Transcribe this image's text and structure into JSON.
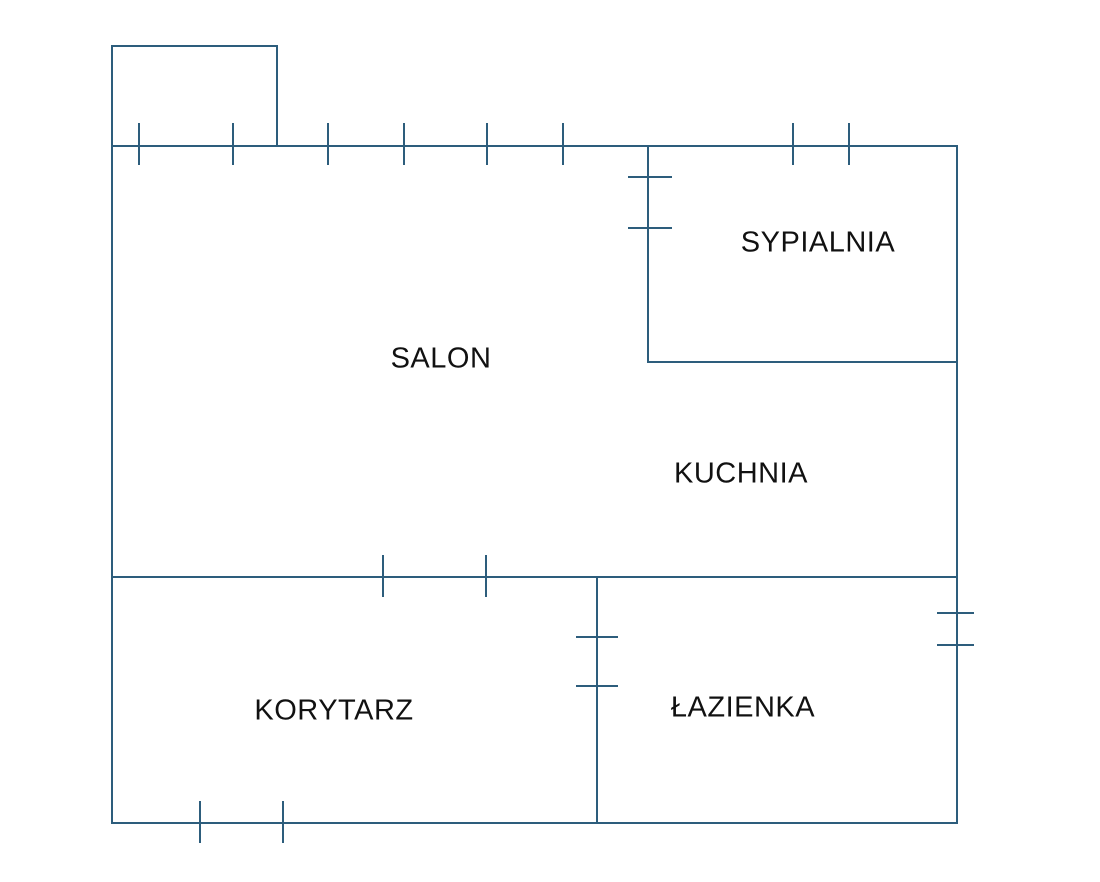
{
  "floor_plan": {
    "type": "apartment-floor-plan",
    "wall_color": "#2d5d7c",
    "label_color": "#111111",
    "rooms": [
      {
        "name": "salon",
        "label": "SALON"
      },
      {
        "name": "sypialnia",
        "label": "SYPIALNIA"
      },
      {
        "name": "kuchnia",
        "label": "KUCHNIA"
      },
      {
        "name": "korytarz",
        "label": "KORYTARZ"
      },
      {
        "name": "lazienka",
        "label": "ŁAZIENKA"
      }
    ]
  }
}
